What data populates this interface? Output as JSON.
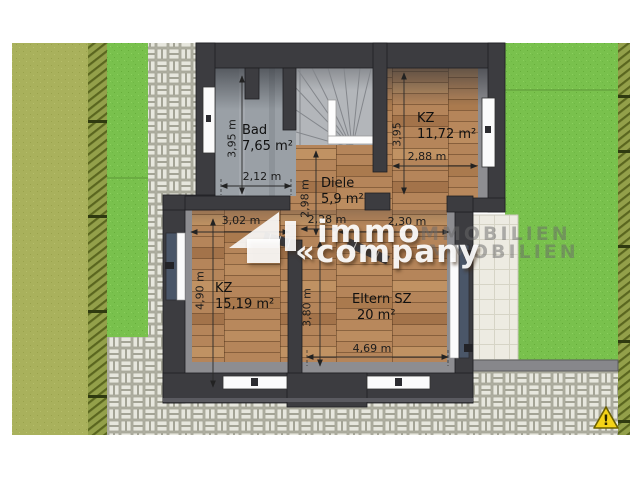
{
  "rooms": {
    "bad": {
      "name": "Bad",
      "area": "7,65 m²"
    },
    "kz_top": {
      "name": "KZ",
      "area": "11,72 m²"
    },
    "diele": {
      "name": "Diele",
      "area": "5,9 m²"
    },
    "kz_left": {
      "name": "KZ",
      "area": "15,19 m²"
    },
    "eltern": {
      "name": "Eltern SZ",
      "area": "20 m²"
    }
  },
  "dimensions": {
    "bad_width": "2,12 m",
    "bad_height": "3,95 m",
    "kz_top_width": "2,88 m",
    "kz_top_height": "3,95",
    "diele_width": "2,28 m",
    "diele_height": "2,98 m",
    "opening_width": "2,30 m",
    "kz_left_width": "3,02 m",
    "kz_left_height": "4,90 m",
    "eltern_width": "4,69 m",
    "eltern_height": "3,80 m"
  },
  "watermark": {
    "line1": "immo",
    "line2": "«company",
    "ghost1": "IMMOBILIEN",
    "ghost2": "IMMOBILIEN"
  },
  "icons": {
    "warning_mark": "!"
  },
  "colors": {
    "wall": "#3c3c40",
    "wood": "#b5855a",
    "grass": "#79c14d",
    "grass_olive": "#a9b15c",
    "paving": "#e7e7de",
    "terrace": "#edebe2",
    "glass": "#4a5668",
    "warning": "#f4d318"
  }
}
